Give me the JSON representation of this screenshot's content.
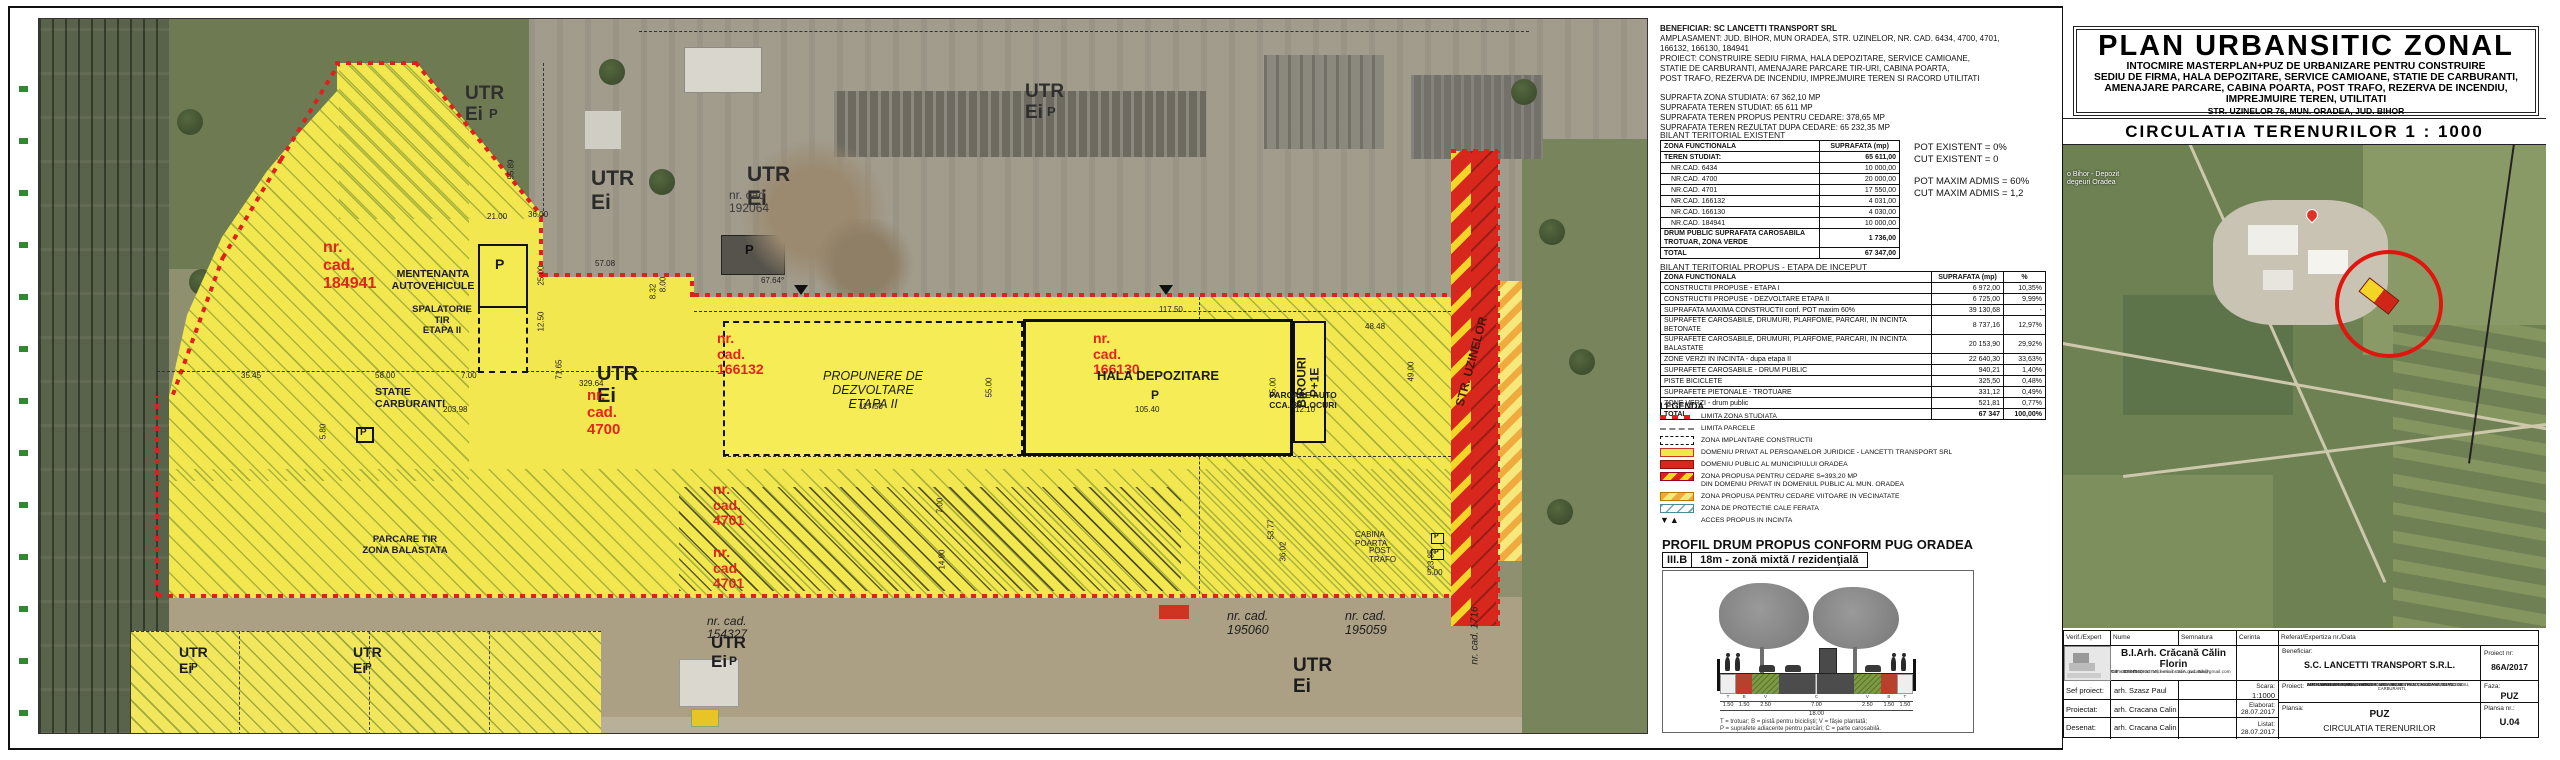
{
  "plan": {
    "small_p": "P",
    "labels": [
      {
        "n": "label-utr-ei-1",
        "t": "UTR Ei",
        "x": 426,
        "y": 64,
        "fs": 19,
        "b": 1,
        "c": "#2f2f2f"
      },
      {
        "n": "label-p-1",
        "t": "P",
        "x": 450,
        "y": 88,
        "fs": 13,
        "b": 1,
        "c": "#2f2f2f"
      },
      {
        "n": "label-utr-ei-2",
        "t": "UTR Ei",
        "x": 552,
        "y": 148,
        "fs": 21,
        "b": 1,
        "c": "#2b2b2b"
      },
      {
        "n": "label-utr-ei-3",
        "t": "UTR Ei",
        "x": 708,
        "y": 144,
        "fs": 21,
        "b": 1,
        "c": "#2b2b2b"
      },
      {
        "n": "label-nr-cad-192064",
        "t": "nr. cad 192064",
        "x": 690,
        "y": 170,
        "fs": 12,
        "c": "#3a3a3a"
      },
      {
        "n": "label-utr-ei-4",
        "t": "UTR Ei",
        "x": 986,
        "y": 62,
        "fs": 19,
        "b": 1,
        "c": "#2f2f2f"
      },
      {
        "n": "label-p-2",
        "t": "P",
        "x": 1008,
        "y": 86,
        "fs": 13,
        "b": 1,
        "c": "#2f2f2f"
      },
      {
        "n": "label-p-building",
        "t": "P",
        "x": 706,
        "y": 224,
        "fs": 13,
        "b": 1,
        "c": "#111"
      },
      {
        "n": "label-nr-cad-184941",
        "t": "nr. cad. 184941",
        "x": 284,
        "y": 220,
        "fs": 16,
        "b": 1,
        "c": "#e0261c"
      },
      {
        "n": "label-mentenanta",
        "t": "MENTENANTA\nAUTOVEHICULE",
        "x": 348,
        "y": 250,
        "fs": 10.5,
        "b": 1,
        "ta": "center",
        "w": 92
      },
      {
        "n": "label-p-mentenanta",
        "t": "P",
        "x": 456,
        "y": 238,
        "fs": 14,
        "b": 1
      },
      {
        "n": "label-spalatorie",
        "t": "SPALATORIE\nTIR\nETAPA II",
        "x": 372,
        "y": 286,
        "fs": 9.5,
        "b": 1,
        "ta": "center",
        "w": 62
      },
      {
        "n": "label-utr-ei-5",
        "t": "UTR Ei",
        "x": 558,
        "y": 344,
        "fs": 20,
        "b": 1
      },
      {
        "n": "label-nr-cad-4700",
        "t": "nr. cad. 4700",
        "x": 548,
        "y": 369,
        "fs": 15,
        "b": 1,
        "c": "#e0261c"
      },
      {
        "n": "label-statie-carburanti",
        "t": "STATIE CARBURANTI",
        "x": 336,
        "y": 368,
        "fs": 10.5,
        "b": 1
      },
      {
        "n": "label-p-statie",
        "t": "P",
        "x": 321,
        "y": 408,
        "fs": 10,
        "b": 1
      },
      {
        "n": "label-nr-cad-166132",
        "t": "nr. cad. 166132",
        "x": 678,
        "y": 312,
        "fs": 14,
        "b": 1,
        "c": "#e0261c"
      },
      {
        "n": "label-propunere",
        "t": "PROPUNERE DE DEZVOLTARE\nETAPA II",
        "x": 744,
        "y": 350,
        "fs": 12.5,
        "i": 1,
        "ta": "center",
        "w": 180
      },
      {
        "n": "label-nr-cad-166130",
        "t": "nr. cad. 166130",
        "x": 1054,
        "y": 312,
        "fs": 14,
        "b": 1,
        "c": "#e0261c"
      },
      {
        "n": "label-hala-depozitare",
        "t": "HALA DEPOZITARE",
        "x": 1044,
        "y": 350,
        "fs": 13,
        "b": 1,
        "ta": "center",
        "w": 150
      },
      {
        "n": "label-p-hala",
        "t": "P",
        "x": 1112,
        "y": 370,
        "fs": 12,
        "b": 1
      },
      {
        "n": "label-nr-cad-4701-a",
        "t": "nr. cad. 4701",
        "x": 674,
        "y": 463,
        "fs": 14,
        "b": 1,
        "c": "#e0261c"
      },
      {
        "n": "label-nr-cad-4701-b",
        "t": "nr. cad. 4701",
        "x": 674,
        "y": 526,
        "fs": 14,
        "b": 1,
        "c": "#e0261c"
      },
      {
        "n": "label-parcare-tir",
        "t": "PARCARE TIR\nZONA BALASTATA",
        "x": 308,
        "y": 516,
        "fs": 9.5,
        "b": 1,
        "ta": "center",
        "w": 116
      },
      {
        "n": "label-parcare-auto",
        "t": "PARCARE AUTO\nCCA. 86 LOCURI",
        "x": 1212,
        "y": 372,
        "fs": 8.5,
        "b": 1,
        "ta": "center",
        "w": 104
      },
      {
        "n": "label-birouri",
        "t": "BIROURI\nP+1E",
        "x": 1230,
        "y": 350,
        "fs": 12,
        "b": 1,
        "r": -90,
        "ta": "center",
        "w": 80
      },
      {
        "n": "label-str-uzinelor",
        "t": "STR. UZINELOR",
        "x": 1378,
        "y": 336,
        "fs": 12,
        "b": 1,
        "r": -75,
        "c": "#4a150b",
        "w": 110,
        "ta": "center"
      },
      {
        "n": "label-cabina-poarta",
        "t": "CABINA POARTA",
        "x": 1316,
        "y": 512,
        "fs": 8
      },
      {
        "n": "label-post-trafo",
        "t": "POST TRAFO",
        "x": 1330,
        "y": 528,
        "fs": 8
      },
      {
        "n": "label-p-cabina",
        "t": "P",
        "x": 1395,
        "y": 514,
        "fs": 7,
        "b": 1
      },
      {
        "n": "label-p-trafo",
        "t": "P",
        "x": 1395,
        "y": 530,
        "fs": 7,
        "b": 1
      },
      {
        "n": "label-nr-cad-154327",
        "t": "nr. cad. 154327",
        "x": 668,
        "y": 596,
        "fs": 12,
        "i": 1
      },
      {
        "n": "label-utr-ei-6",
        "t": "UTR Ei",
        "x": 672,
        "y": 614,
        "fs": 17,
        "b": 1
      },
      {
        "n": "label-p-3",
        "t": "P",
        "x": 690,
        "y": 636,
        "fs": 12,
        "b": 1
      },
      {
        "n": "label-nr-cad-195060",
        "t": "nr. cad. 195060",
        "x": 1188,
        "y": 590,
        "fs": 12.5,
        "i": 1
      },
      {
        "n": "label-nr-cad-195059",
        "t": "nr. cad. 195059",
        "x": 1306,
        "y": 590,
        "fs": 12.5,
        "i": 1
      },
      {
        "n": "label-utr-ei-7",
        "t": "UTR Ei",
        "x": 1254,
        "y": 636,
        "fs": 19,
        "b": 1
      },
      {
        "n": "label-utr-ei-8",
        "t": "UTR Ei",
        "x": 140,
        "y": 626,
        "fs": 14,
        "b": 1
      },
      {
        "n": "label-p-4",
        "t": "P",
        "x": 152,
        "y": 643,
        "fs": 10,
        "b": 1
      },
      {
        "n": "label-utr-ei-9",
        "t": "UTR Ei",
        "x": 314,
        "y": 626,
        "fs": 14,
        "b": 1
      },
      {
        "n": "label-p-5",
        "t": "P",
        "x": 326,
        "y": 643,
        "fs": 10,
        "b": 1
      },
      {
        "n": "label-nr-cad-1716",
        "t": "nr. cad. 1716",
        "x": 1396,
        "y": 600,
        "fs": 10,
        "i": 1,
        "r": -90,
        "w": 80
      }
    ],
    "dims": [
      {
        "t": "57.08",
        "x": 556,
        "y": 240
      },
      {
        "t": "21.00",
        "x": 448,
        "y": 193
      },
      {
        "t": "36.00",
        "x": 489,
        "y": 191
      },
      {
        "t": "55.89",
        "x": 462,
        "y": 146,
        "r": -90
      },
      {
        "t": "25.00",
        "x": 492,
        "y": 252,
        "r": -90
      },
      {
        "t": "12.50",
        "x": 492,
        "y": 298,
        "r": -90
      },
      {
        "t": "329.64",
        "x": 540,
        "y": 360
      },
      {
        "t": "35.45",
        "x": 202,
        "y": 352
      },
      {
        "t": "58.00",
        "x": 336,
        "y": 352
      },
      {
        "t": "7.00",
        "x": 422,
        "y": 352
      },
      {
        "t": "203.98",
        "x": 404,
        "y": 386
      },
      {
        "t": "5.80",
        "x": 276,
        "y": 408,
        "r": -90
      },
      {
        "t": "71.65",
        "x": 510,
        "y": 346,
        "r": -90
      },
      {
        "t": "117.50",
        "x": 820,
        "y": 383
      },
      {
        "t": "117.50",
        "x": 1120,
        "y": 286
      },
      {
        "t": "105.40",
        "x": 1096,
        "y": 386
      },
      {
        "t": "55.00",
        "x": 940,
        "y": 364,
        "r": -90
      },
      {
        "t": "55.00",
        "x": 1224,
        "y": 364,
        "r": -90
      },
      {
        "t": "12.10",
        "x": 1256,
        "y": 386
      },
      {
        "t": "48.48",
        "x": 1326,
        "y": 303
      },
      {
        "t": "49.00",
        "x": 1362,
        "y": 348,
        "r": -90
      },
      {
        "t": "7.00",
        "x": 893,
        "y": 482,
        "r": -90
      },
      {
        "t": "14.90",
        "x": 893,
        "y": 536,
        "r": -90
      },
      {
        "t": "53.77",
        "x": 1222,
        "y": 506,
        "r": -90
      },
      {
        "t": "36.02",
        "x": 1234,
        "y": 528,
        "r": -90
      },
      {
        "t": "23.85",
        "x": 1382,
        "y": 536,
        "r": -90
      },
      {
        "t": "5.00",
        "x": 1388,
        "y": 549
      },
      {
        "t": "67.64°",
        "x": 722,
        "y": 257
      },
      {
        "t": "8.32",
        "x": 606,
        "y": 268,
        "r": -90
      },
      {
        "t": "8.00",
        "x": 616,
        "y": 261,
        "r": -90
      }
    ]
  },
  "panel": {
    "info_lines": [
      "BENEFICIAR: SC LANCETTI TRANSPORT SRL",
      "AMPLASAMENT: JUD. BIHOR, MUN ORADEA, STR. UZINELOR, NR. CAD. 6434, 4700, 4701,",
      "166132, 166130, 184941",
      "PROIECT: CONSTRUIRE SEDIU FIRMA, HALA DEPOZITARE, SERVICE CAMIOANE,",
      "STATIE DE CARBURANTI, AMENAJARE PARCARE TIR-URI, CABINA POARTA,",
      "POST TRAFO, REZERVA DE INCENDIU, IMPREJMUIRE TEREN SI RACORD UTILITATI",
      "",
      "SUPRAFTA ZONA STUDIATA: 67 362,10 MP",
      "SUPRAFATA TEREN STUDIAT: 65 611 MP",
      "SUPRAFATA TEREN PROPUS PENTRU CEDARE: 378,65 MP",
      "SUPRAFATA TEREN REZULTAT DUPA CEDARE: 65 232,35 MP"
    ],
    "bilant1_title": "BILANT TERITORIAL EXISTENT",
    "table1": {
      "headers": [
        "ZONA FUNCTIONALA",
        "SUPRAFATA (mp)"
      ],
      "rows": [
        {
          "c": [
            "TEREN STUDIAT:",
            "65 611,00"
          ],
          "b": true
        },
        {
          "c": [
            "NR.CAD. 6434",
            "10 000,00"
          ],
          "ind": true
        },
        {
          "c": [
            "NR.CAD. 4700",
            "20 000,00"
          ],
          "ind": true
        },
        {
          "c": [
            "NR.CAD. 4701",
            "17 550,00"
          ],
          "ind": true
        },
        {
          "c": [
            "NR.CAD. 166132",
            "4 031,00"
          ],
          "ind": true
        },
        {
          "c": [
            "NR.CAD. 166130",
            "4 030,00"
          ],
          "ind": true
        },
        {
          "c": [
            "NR.CAD. 184941",
            "10 000,00"
          ],
          "ind": true
        },
        {
          "c": [
            "DRUM PUBLIC SUPRAFATA CAROSABILA\nTROTUAR,  ZONA VERDE",
            "1 736,00"
          ],
          "b": true
        },
        {
          "c": [
            "TOTAL",
            "67 347,00"
          ],
          "b": true
        }
      ]
    },
    "notes": [
      "POT EXISTENT = 0%",
      "CUT EXISTENT = 0",
      "",
      "POT MAXIM ADMIS = 60%",
      "CUT MAXIM ADMIS = 1,2"
    ],
    "bilant2_title": "BILANT TERITORIAL PROPUS - ETAPA DE INCEPUT",
    "table2": {
      "headers": [
        "ZONA FUNCTIONALA",
        "SUPRAFATA (mp)",
        "%"
      ],
      "rows": [
        {
          "c": [
            "CONSTRUCTII PROPUSE - ETAPA I",
            "6 972,00",
            "10,35%"
          ]
        },
        {
          "c": [
            "CONSTRUCTII PROPUSE - DEZVOLTARE ETAPA II",
            "6 725,00",
            "9,99%"
          ]
        },
        {
          "c": [
            "SUPRAFATA MAXIMA CONSTRUCTII conf. POT maxim 60%",
            "39 130,68",
            "-"
          ]
        },
        {
          "c": [
            "SUPRAFETE CAROSABILE, DRUMURI, PLARFOME, PARCARI, IN INCINTA BETONATE",
            "8 737,16",
            "12,97%"
          ]
        },
        {
          "c": [
            "SUPRAFETE CAROSABILE, DRUMURI, PLARFOME, PARCARI, IN INCINTA BALASTATE",
            "20 153,90",
            "29,92%"
          ]
        },
        {
          "c": [
            "ZONE VERZI IN INCINTA - dupa etapa II",
            "22 640,30",
            "33,63%"
          ]
        },
        {
          "c": [
            "SUPRAFETE CAROSABILE - DRUM PUBLIC",
            "940,21",
            "1,40%"
          ]
        },
        {
          "c": [
            "PISTE BICICLETE",
            "325,50",
            "0,48%"
          ]
        },
        {
          "c": [
            "SUPRAFETE PIETONALE - TROTUARE",
            "331,12",
            "0,49%"
          ]
        },
        {
          "c": [
            "ZONE VERZI - drum public",
            "521,81",
            "0,77%"
          ]
        },
        {
          "c": [
            "TOTAL",
            "67 347",
            "100,00%"
          ],
          "b": true
        }
      ]
    },
    "legend": {
      "title": "LEGENDA",
      "items": [
        {
          "k": "limita-studiata",
          "t": "LIMITA ZONA STUDIATA"
        },
        {
          "k": "limita-parcele",
          "t": "LIMITA PARCELE"
        },
        {
          "k": "zona-implantare",
          "t": "ZONA IMPLANTARE CONSTRUCTII"
        },
        {
          "k": "domeniu-privat",
          "t": "DOMENIU PRIVAT AL PERSOANELOR JURIDICE - LANCETTI TRANSPORT SRL"
        },
        {
          "k": "domeniu-public",
          "t": "DOMENIU PUBLIC AL MUNICIPIULUI ORADEA"
        },
        {
          "k": "zona-cedare",
          "t": "ZONA PROPUSA PENTRU CEDARE S=393,20 MP\nDIN DOMENIU PRIVAT IN DOMENIUL PUBLIC AL MUN. ORADEA"
        },
        {
          "k": "zona-cedare-viitoare",
          "t": "ZONA PROPUSA PENTRU CEDARE VIITOARE IN VECINATATE"
        },
        {
          "k": "zona-protectie",
          "t": "ZONA DE PROTECTIE CALE FERATA"
        },
        {
          "k": "acces",
          "t": "ACCES PROPUS IN INCINTA"
        }
      ]
    },
    "profile": {
      "title": "PROFIL DRUM PROPUS CONFORM PUG ORADEA",
      "code": "III.B",
      "desc": "18m - zonă mixtă / rezidenţială",
      "segments": [
        {
          "w": 1.5,
          "type": "T",
          "dim": "1.50"
        },
        {
          "w": 1.5,
          "type": "B",
          "dim": "1.50"
        },
        {
          "w": 2.5,
          "type": "V",
          "dim": "2.50"
        },
        {
          "w": 7.0,
          "type": "C",
          "dim": "7.00"
        },
        {
          "w": 2.5,
          "type": "V",
          "dim": "2.50"
        },
        {
          "w": 1.5,
          "type": "B",
          "dim": "1.50"
        },
        {
          "w": 1.5,
          "type": "T",
          "dim": "1.50"
        }
      ],
      "total": "18.00",
      "legend_line1": "T = trotuar;    B = pistă pentru biciclişti;    V = fâşie plantată;",
      "legend_line2": "P = suprafete adiacente pentru parcări;    C = parte carosabilă."
    }
  },
  "titlebox": {
    "title": "PLAN URBANSITIC ZONAL",
    "sub": [
      "INTOCMIRE MASTERPLAN+PUZ DE URBANIZARE PENTRU CONSTRUIRE",
      "SEDIU DE FIRMA, HALA DEPOZITARE, SERVICE CAMIOANE, STATIE DE CARBURANTI,",
      "AMENAJARE PARCARE, CABINA POARTA, POST TRAFO, REZERVA DE INCENDIU,",
      "IMPREJMUIRE TEREN, UTILITATI"
    ],
    "address": "STR. UZINELOR 76, MUN. ORADEA, JUD. BIHOR",
    "section": "CIRCULATIA TERENURILOR  1 : 1000",
    "map_label": "o Bihor - Depozit\ndegeuri Oradea"
  },
  "titleblock": {
    "headers": [
      "Verif./Expert",
      "Nume",
      "Semnatura",
      "Cerinta",
      "Referat/Expertiza nr./Data"
    ],
    "architect": "B.I.Arh. Crăcană Călin Florin",
    "architect_details": [
      "Com. Osorhei, sat Felcheriu nr.91A, jud. Bihor",
      "Tel: +40 745 18 93 10; e-mail: calin.cracana@gmail.com",
      "CIF: 31097010"
    ],
    "beneficiar_label": "Beneficiar:",
    "beneficiar": "S.C. LANCETTI TRANSPORT S.R.L.",
    "proiect_nr_label": "Proiect nr:",
    "proiect_nr": "86A/2017",
    "rows": [
      {
        "role": "Sef proiect:",
        "name": "arh. Szasz Paul"
      },
      {
        "role": "Proiectat:",
        "name": "arh. Cracana Calin"
      },
      {
        "role": "Desenat:",
        "name": "arh. Cracana Calin"
      }
    ],
    "scara_label": "Scara:",
    "scara": "1:1000",
    "elaborat_label": "Elaborat:",
    "elaborat": "28.07.2017",
    "listat_label": "Listat:",
    "listat": "28.07.2017",
    "proiect_label": "Proiect:",
    "proiect_text": [
      "INTOCMIRE MASTERPLAN+PUZ DE URBANIZARE PENTRU CONSTRUIRE",
      "SEDIU DE FIRMA, HALA DEPOZITARE, SERVICE CAMIOANE, STATIE DE CARBURANTI,",
      "AMENAJARE PARCARE, CABINA POARTA, POST TRAFO, REZERVA DE INCENDIU,",
      "IMPREJMUIRE TEREN, UTILITATI",
      "STR. UZINELOR 76, MUN. ORADEA, JUD. BIHOR"
    ],
    "faza_label": "Faza:",
    "faza": "PUZ",
    "plansa_label": "Plansa:",
    "plansa1": "PUZ",
    "plansa2": "CIRCULATIA TERENURILOR",
    "plansa_nr_label": "Plansa nr.:",
    "plansa_nr": "U.04"
  }
}
